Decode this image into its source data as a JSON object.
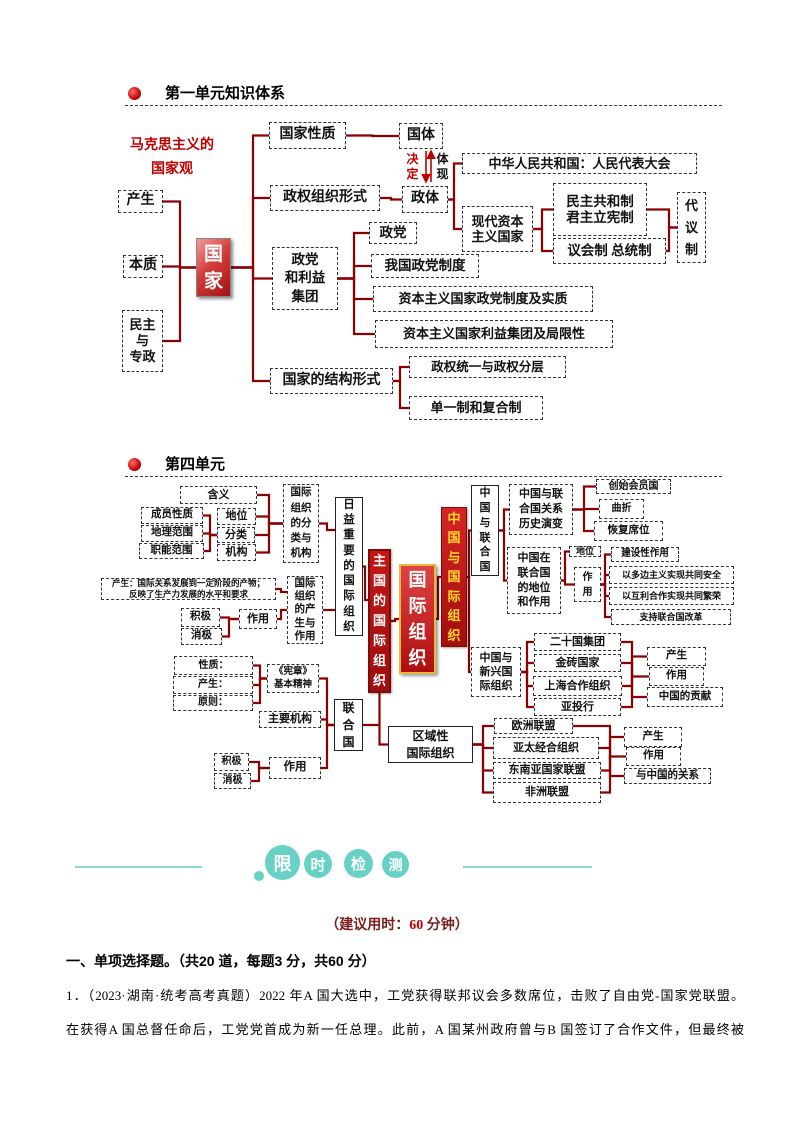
{
  "colors": {
    "connector": "#8b0000",
    "arrow": "#c00000",
    "teal": "#68d1c6",
    "teal_line": "#8adcd3",
    "dark_red_text": "#7b1d1d",
    "accent_red": "#c00000"
  },
  "section1": {
    "title": "第一单元知识体系"
  },
  "section2": {
    "title": "第四单元"
  },
  "diagram1": {
    "label": "马克思主义的\n国家观",
    "nodes": [
      {
        "id": "mk",
        "t": "马克思主义的\n国家观",
        "x": 120,
        "y": 136,
        "w": 104,
        "h": 44,
        "cls": "plain",
        "fs": 14,
        "col": "#c00000",
        "lh": "1.75"
      },
      {
        "id": "chansheng1",
        "t": "产生",
        "x": 118,
        "y": 190,
        "w": 45,
        "h": 23,
        "fs": 14
      },
      {
        "id": "benzhi",
        "t": "本质",
        "x": 123,
        "y": 255,
        "w": 40,
        "h": 23,
        "fs": 14
      },
      {
        "id": "minzhu",
        "t": "民主\n与\n专政",
        "x": 122,
        "y": 310,
        "w": 41,
        "h": 62,
        "fs": 13,
        "lh": "1.25"
      },
      {
        "id": "guojia",
        "t": "国\n家",
        "x": 196,
        "y": 238,
        "w": 35,
        "h": 59,
        "cls": "gj",
        "fs": 19,
        "lh": "27px"
      },
      {
        "id": "gjxz",
        "t": "国家性质",
        "x": 269,
        "y": 122,
        "w": 77,
        "h": 27,
        "fs": 14
      },
      {
        "id": "guoti",
        "t": "国体",
        "x": 399,
        "y": 123,
        "w": 44,
        "h": 26,
        "fs": 14
      },
      {
        "id": "jueding",
        "t": "决\n定",
        "x": 404,
        "y": 151,
        "w": 17,
        "h": 32,
        "cls": "plain",
        "fs": 12,
        "col": "#c00000",
        "lh": "15px"
      },
      {
        "id": "tixian",
        "t": "体\n现",
        "x": 434,
        "y": 151,
        "w": 17,
        "h": 32,
        "cls": "plain",
        "fs": 12,
        "lh": "15px"
      },
      {
        "id": "zqzzxs",
        "t": "政权组织形式",
        "x": 270,
        "y": 185,
        "w": 110,
        "h": 26,
        "fs": 14
      },
      {
        "id": "zhengti",
        "t": "政体",
        "x": 402,
        "y": 186,
        "w": 46,
        "h": 27,
        "fs": 14
      },
      {
        "id": "zhonghua",
        "t": "中华人民共和国：人民代表大会",
        "x": 462,
        "y": 153,
        "w": 235,
        "h": 21,
        "fs": 13
      },
      {
        "id": "xiandai",
        "t": "现代资本\n主义国家",
        "x": 462,
        "y": 206,
        "w": 71,
        "h": 46,
        "fs": 13
      },
      {
        "id": "minzhugonghe",
        "t": "民主共和制\n君主立宪制",
        "x": 553,
        "y": 183,
        "w": 94,
        "h": 53,
        "fs": 13.5
      },
      {
        "id": "yihui",
        "t": "议会制 总统制",
        "x": 553,
        "y": 238,
        "w": 113,
        "h": 26,
        "fs": 13.5
      },
      {
        "id": "daiyizhi",
        "t": "代\n议\n制",
        "x": 677,
        "y": 192,
        "w": 29,
        "h": 71,
        "fs": 13,
        "lh": "22px"
      },
      {
        "id": "zhengdang",
        "t": "政党",
        "x": 369,
        "y": 222,
        "w": 48,
        "h": 22,
        "fs": 13.5
      },
      {
        "id": "zdlyjt",
        "t": "政党\n和利益\n集团",
        "x": 272,
        "y": 247,
        "w": 66,
        "h": 63,
        "fs": 13.5,
        "lh": "1.35"
      },
      {
        "id": "wgzd",
        "t": "我国政党制度",
        "x": 371,
        "y": 254,
        "w": 108,
        "h": 24,
        "fs": 13.5
      },
      {
        "id": "zbzy1",
        "t": "资本主义国家政党制度及实质",
        "x": 373,
        "y": 286,
        "w": 220,
        "h": 26,
        "fs": 13
      },
      {
        "id": "zbzy2",
        "t": "资本主义国家利益集团及局限性",
        "x": 375,
        "y": 320,
        "w": 238,
        "h": 28,
        "fs": 13
      },
      {
        "id": "jgxs",
        "t": "国家的结构形式",
        "x": 270,
        "y": 368,
        "w": 123,
        "h": 26,
        "fs": 14
      },
      {
        "id": "zqty",
        "t": "政权统一与政权分层",
        "x": 409,
        "y": 356,
        "w": 157,
        "h": 22,
        "fs": 12.5
      },
      {
        "id": "dyz",
        "t": "单一制和复合制",
        "x": 409,
        "y": 396,
        "w": 134,
        "h": 24,
        "fs": 13
      }
    ],
    "edges": [
      [
        "chansheng1",
        "guojia",
        180
      ],
      [
        "benzhi",
        "guojia",
        180
      ],
      [
        "minzhu",
        "guojia",
        180
      ],
      [
        "guojia",
        "gjxz",
        253
      ],
      [
        "guojia",
        "zqzzxs",
        253
      ],
      [
        "guojia",
        "zdlyjt",
        253
      ],
      [
        "guojia",
        "jgxs",
        253
      ],
      [
        "gjxz",
        "guoti"
      ],
      [
        "zqzzxs",
        "zhengti"
      ],
      [
        "zhengti",
        "zhonghua",
        454
      ],
      [
        "zhengti",
        "xiandai",
        454
      ],
      [
        "xiandai",
        "minzhugonghe",
        542
      ],
      [
        "xiandai",
        "yihui",
        542
      ],
      [
        "minzhugonghe",
        "daiyizhi",
        669
      ],
      [
        "yihui",
        "daiyizhi",
        669
      ],
      [
        "zdlyjt",
        "zhengdang",
        354
      ],
      [
        "zdlyjt",
        "wgzd",
        354
      ],
      [
        "zdlyjt",
        "zbzy1",
        354
      ],
      [
        "zdlyjt",
        "zbzy2",
        354
      ],
      [
        "jgxs",
        "zqty",
        400
      ],
      [
        "jgxs",
        "dyz",
        400
      ]
    ],
    "arrows": [
      {
        "x": 426,
        "y1": 151,
        "y2": 182
      },
      {
        "x": 431,
        "y1": 182,
        "y2": 151
      }
    ]
  },
  "diagram2": {
    "nodes": [
      {
        "id": "hanyi",
        "t": "含义",
        "x": 180,
        "y": 486,
        "w": 77,
        "h": 18,
        "fs": 11
      },
      {
        "id": "cyxz",
        "t": "成员性质",
        "x": 141,
        "y": 507,
        "w": 62,
        "h": 17,
        "fs": 10.5
      },
      {
        "id": "dlfw",
        "t": "地理范围",
        "x": 141,
        "y": 525,
        "w": 62,
        "h": 17,
        "fs": 10.5
      },
      {
        "id": "znfw",
        "t": "职能范围",
        "x": 139,
        "y": 543,
        "w": 65,
        "h": 16,
        "fs": 10.5
      },
      {
        "id": "diwei_l",
        "t": "地位",
        "x": 217,
        "y": 508,
        "w": 39,
        "h": 17,
        "fs": 11
      },
      {
        "id": "fenlei",
        "t": "分类",
        "x": 217,
        "y": 527,
        "w": 38,
        "h": 16,
        "fs": 11
      },
      {
        "id": "jigou",
        "t": "机构",
        "x": 217,
        "y": 544,
        "w": 39,
        "h": 17,
        "fs": 11
      },
      {
        "id": "fljg",
        "t": "国际\n组织\n的分\n类与\n机构",
        "x": 283,
        "y": 484,
        "w": 36,
        "h": 79,
        "fs": 10.5,
        "lh": "15.2px"
      },
      {
        "id": "riyi",
        "t": "日\n益\n重\n要\n的\n国\n际\n组\n织",
        "x": 335,
        "y": 497,
        "w": 28,
        "h": 139,
        "cls": "s",
        "fs": 11.5,
        "lh": "15.2px"
      },
      {
        "id": "cs_long",
        "t": "产生：国际关系发展到一定阶段的产物；\n反映了生产力发展的水平和要求",
        "x": 101,
        "y": 578,
        "w": 175,
        "h": 22,
        "fs": 8.5,
        "lh": "1.25"
      },
      {
        "id": "jiji1",
        "t": "积极",
        "x": 181,
        "y": 608,
        "w": 39,
        "h": 19,
        "fs": 10.5
      },
      {
        "id": "xiaoji1",
        "t": "消极",
        "x": 181,
        "y": 628,
        "w": 41,
        "h": 17,
        "fs": 10.5
      },
      {
        "id": "zuoyong_l",
        "t": "作用",
        "x": 239,
        "y": 609,
        "w": 38,
        "h": 20,
        "fs": 11
      },
      {
        "id": "cszy",
        "t": "国际\n组织\n的产\n生与\n作用",
        "x": 287,
        "y": 576,
        "w": 36,
        "h": 68,
        "fs": 10.5,
        "lh": "13.2px"
      },
      {
        "id": "zhuguo",
        "t": "主\n国\n的\n国\n际\n组\n织",
        "x": 368,
        "y": 549,
        "w": 23,
        "h": 144,
        "cls": "redv",
        "fs": 13,
        "lh": "20px"
      },
      {
        "id": "gjzz",
        "t": "国\n际\n组\n织",
        "x": 399,
        "y": 564,
        "w": 37,
        "h": 110,
        "cls": "redc",
        "fs": 18,
        "lh": "26px"
      },
      {
        "id": "zgygjzz",
        "t": "中\n国\n与\n国\n际\n组\n织",
        "x": 441,
        "y": 507,
        "w": 26,
        "h": 140,
        "cls": "redy",
        "fs": 13,
        "lh": "19.5px"
      },
      {
        "id": "zgylhg",
        "t": "中\n国\n与\n联\n合\n国",
        "x": 471,
        "y": 485,
        "w": 28,
        "h": 91,
        "cls": "s",
        "fs": 11,
        "lh": "14.8px"
      },
      {
        "id": "gxls",
        "t": "中国与联\n合国关系\n历史演变",
        "x": 509,
        "y": 484,
        "w": 64,
        "h": 51,
        "fs": 11,
        "lh": "1.35"
      },
      {
        "id": "cshyg",
        "t": "创始会员国",
        "x": 596,
        "y": 479,
        "w": 75,
        "h": 15,
        "fs": 10
      },
      {
        "id": "quzhe",
        "t": "曲折",
        "x": 599,
        "y": 499,
        "w": 45,
        "h": 20,
        "fs": 10
      },
      {
        "id": "hfxw",
        "t": "恢复席位",
        "x": 594,
        "y": 521,
        "w": 69,
        "h": 20,
        "fs": 10.5
      },
      {
        "id": "zgzlhg",
        "t": "中国在\n联合国\n的地位\n和作用",
        "x": 507,
        "y": 547,
        "w": 54,
        "h": 67,
        "fs": 11,
        "lh": "1.35"
      },
      {
        "id": "diwei_r",
        "t": "地位",
        "x": 569,
        "y": 546,
        "w": 32,
        "h": 11,
        "fs": 9
      },
      {
        "id": "zuoyong_r",
        "t": "作\n用",
        "x": 574,
        "y": 567,
        "w": 27,
        "h": 35,
        "fs": 10,
        "lh": "15px"
      },
      {
        "id": "jsxzy",
        "t": "建设性作用",
        "x": 611,
        "y": 547,
        "w": 68,
        "h": 15,
        "fs": 9.5
      },
      {
        "id": "ydbzy",
        "t": "以多边主义实现共同安全",
        "x": 609,
        "y": 566,
        "w": 125,
        "h": 18,
        "fs": 9
      },
      {
        "id": "yhlhz",
        "t": "以互利合作实现共同繁荣",
        "x": 609,
        "y": 587,
        "w": 125,
        "h": 18,
        "fs": 9
      },
      {
        "id": "zclhg",
        "t": "支持联合国改革",
        "x": 611,
        "y": 609,
        "w": 120,
        "h": 16,
        "fs": 9
      },
      {
        "id": "zgyxx",
        "t": "中国与\n新兴国\n际组织",
        "x": 471,
        "y": 647,
        "w": 50,
        "h": 50,
        "fs": 11,
        "lh": "1.3"
      },
      {
        "id": "esg",
        "t": "二十国集团",
        "x": 534,
        "y": 633,
        "w": 87,
        "h": 18,
        "fs": 11
      },
      {
        "id": "jz",
        "t": "金砖国家",
        "x": 534,
        "y": 654,
        "w": 87,
        "h": 18,
        "fs": 11
      },
      {
        "id": "shhz",
        "t": "上海合作组织",
        "x": 533,
        "y": 676,
        "w": 89,
        "h": 20,
        "fs": 11
      },
      {
        "id": "ytouh",
        "t": "亚投行",
        "x": 534,
        "y": 698,
        "w": 87,
        "h": 18,
        "fs": 11
      },
      {
        "id": "cs_r1",
        "t": "产生",
        "x": 647,
        "y": 647,
        "w": 59,
        "h": 19,
        "fs": 10.5
      },
      {
        "id": "zy_r1",
        "t": "作用",
        "x": 649,
        "y": 667,
        "w": 55,
        "h": 19,
        "fs": 10.5
      },
      {
        "id": "zggx",
        "t": "中国的贡献",
        "x": 647,
        "y": 687,
        "w": 76,
        "h": 20,
        "fs": 10.5
      },
      {
        "id": "xingzhi",
        "t": "性质：",
        "x": 174,
        "y": 656,
        "w": 79,
        "h": 19,
        "fs": 10
      },
      {
        "id": "chansheng2",
        "t": "产生：",
        "x": 173,
        "y": 676,
        "w": 80,
        "h": 18,
        "fs": 10
      },
      {
        "id": "yuanze",
        "t": "原则：",
        "x": 173,
        "y": 695,
        "w": 80,
        "h": 16,
        "fs": 10
      },
      {
        "id": "xianzhang",
        "t": "《宪章》\n基本精神",
        "x": 267,
        "y": 664,
        "w": 52,
        "h": 29,
        "fs": 9.5,
        "lh": "1.3"
      },
      {
        "id": "zyjg",
        "t": "主要机构",
        "x": 259,
        "y": 711,
        "w": 62,
        "h": 17,
        "fs": 11
      },
      {
        "id": "jiji2",
        "t": "积极",
        "x": 214,
        "y": 753,
        "w": 35,
        "h": 18,
        "fs": 10
      },
      {
        "id": "xiaoji2",
        "t": "消极",
        "x": 214,
        "y": 773,
        "w": 37,
        "h": 16,
        "fs": 10
      },
      {
        "id": "zuoyong2",
        "t": "作用",
        "x": 269,
        "y": 757,
        "w": 52,
        "h": 22,
        "fs": 11.5
      },
      {
        "id": "lhg",
        "t": "联\n合\n国",
        "x": 334,
        "y": 699,
        "w": 29,
        "h": 52,
        "cls": "s",
        "fs": 12,
        "lh": "17px"
      },
      {
        "id": "quyu",
        "t": "区域性\n国际组织",
        "x": 388,
        "y": 726,
        "w": 85,
        "h": 37,
        "cls": "s",
        "fs": 12,
        "lh": "1.4"
      },
      {
        "id": "oumeng",
        "t": "欧洲联盟",
        "x": 494,
        "y": 718,
        "w": 79,
        "h": 16,
        "fs": 11
      },
      {
        "id": "yataijh",
        "t": "亚太经合组织",
        "x": 493,
        "y": 737,
        "w": 106,
        "h": 22,
        "fs": 11
      },
      {
        "id": "dongmeng",
        "t": "东南亚国家联盟",
        "x": 493,
        "y": 762,
        "w": 108,
        "h": 17,
        "fs": 11
      },
      {
        "id": "feimeng",
        "t": "非洲联盟",
        "x": 493,
        "y": 782,
        "w": 108,
        "h": 21,
        "fs": 11
      },
      {
        "id": "cs_r2",
        "t": "产生",
        "x": 624,
        "y": 727,
        "w": 58,
        "h": 20,
        "fs": 10.5
      },
      {
        "id": "zy_r2",
        "t": "作用",
        "x": 626,
        "y": 747,
        "w": 55,
        "h": 19,
        "fs": 10.5
      },
      {
        "id": "yzgdgx",
        "t": "与中国的关系",
        "x": 624,
        "y": 768,
        "w": 87,
        "h": 16,
        "fs": 10.5
      },
      {
        "id": "jx1",
        "t": "",
        "x": 632,
        "y": 677,
        "w": 0,
        "h": 0,
        "jx": true
      },
      {
        "id": "jx2",
        "t": "",
        "x": 610,
        "y": 760,
        "w": 0,
        "h": 0,
        "jx": true
      },
      {
        "id": "jx3",
        "t": "",
        "x": 379,
        "y": 724,
        "w": 0,
        "h": 0,
        "jx": true
      }
    ],
    "edges": [
      [
        "cyxz",
        "fenlei",
        210
      ],
      [
        "dlfw",
        "fenlei",
        210
      ],
      [
        "znfw",
        "fenlei",
        210
      ],
      [
        "hanyi",
        "fljg",
        269
      ],
      [
        "diwei_l",
        "fljg",
        269
      ],
      [
        "fenlei",
        "fljg",
        269
      ],
      [
        "jigou",
        "fljg",
        269
      ],
      [
        "cs_long",
        "cszy",
        281,
        592
      ],
      [
        "jiji1",
        "zuoyong_l",
        229
      ],
      [
        "xiaoji1",
        "zuoyong_l",
        229
      ],
      [
        "zuoyong_l",
        "cszy",
        281
      ],
      [
        "fljg",
        "riyi",
        327,
        530
      ],
      [
        "cszy",
        "riyi",
        329,
        610
      ],
      [
        "riyi",
        "zhuguo",
        365,
        600
      ],
      [
        "zhuguo",
        "gjzz",
        395
      ],
      [
        "gjzz",
        "zgygjzz",
        438
      ],
      [
        "zgygjzz",
        "zgylhg",
        469
      ],
      [
        "zgygjzz",
        "zgyxx",
        469
      ],
      [
        "zgylhg",
        "gxls",
        504
      ],
      [
        "zgylhg",
        "zgzlhg",
        504
      ],
      [
        "gxls",
        "cshyg",
        584
      ],
      [
        "gxls",
        "quzhe",
        584
      ],
      [
        "gxls",
        "hfxw",
        584
      ],
      [
        "zgzlhg",
        "diwei_r",
        565
      ],
      [
        "zgzlhg",
        "zuoyong_r",
        565
      ],
      [
        "zuoyong_r",
        "jsxzy",
        605
      ],
      [
        "zuoyong_r",
        "ydbzy",
        605
      ],
      [
        "zuoyong_r",
        "yhlhz",
        605
      ],
      [
        "zuoyong_r",
        "zclhg",
        605
      ],
      [
        "zgyxx",
        "esg",
        527
      ],
      [
        "zgyxx",
        "jz",
        527
      ],
      [
        "zgyxx",
        "shhz",
        527
      ],
      [
        "zgyxx",
        "ytouh",
        527
      ],
      [
        "esg",
        "jx1",
        632
      ],
      [
        "jz",
        "jx1",
        632
      ],
      [
        "shhz",
        "jx1",
        632
      ],
      [
        "ytouh",
        "jx1",
        632
      ],
      [
        "jx1",
        "cs_r1",
        632
      ],
      [
        "jx1",
        "zy_r1",
        632
      ],
      [
        "jx1",
        "zggx",
        632
      ],
      [
        "xingzhi",
        "xianzhang",
        260
      ],
      [
        "chansheng2",
        "xianzhang",
        260
      ],
      [
        "yuanze",
        "xianzhang",
        260
      ],
      [
        "xianzhang",
        "lhg",
        327
      ],
      [
        "zyjg",
        "lhg",
        327
      ],
      [
        "jiji2",
        "zuoyong2",
        259
      ],
      [
        "xiaoji2",
        "zuoyong2",
        259
      ],
      [
        "zuoyong2",
        "lhg",
        327
      ],
      [
        "lhg",
        "jx3",
        379
      ],
      [
        "zhuguo",
        "quyu",
        0,
        0,
        "v"
      ],
      [
        "quyu",
        "oumeng",
        483
      ],
      [
        "quyu",
        "yataijh",
        483
      ],
      [
        "quyu",
        "dongmeng",
        483
      ],
      [
        "quyu",
        "feimeng",
        483
      ],
      [
        "oumeng",
        "jx2",
        610
      ],
      [
        "yataijh",
        "jx2",
        610
      ],
      [
        "dongmeng",
        "jx2",
        610
      ],
      [
        "feimeng",
        "jx2",
        610
      ],
      [
        "jx2",
        "cs_r2",
        610
      ],
      [
        "jx2",
        "zy_r2",
        610
      ],
      [
        "jx2",
        "yzgdgx",
        610
      ]
    ]
  },
  "timed_test": {
    "badges": [
      {
        "ch": "限",
        "x": 265,
        "y": 845,
        "d": 35,
        "fs": 18
      },
      {
        "ch": "时",
        "x": 304,
        "y": 850,
        "d": 28,
        "fs": 15
      },
      {
        "ch": "检",
        "x": 344,
        "y": 849,
        "d": 29,
        "fs": 15
      },
      {
        "ch": "测",
        "x": 382,
        "y": 851,
        "d": 27,
        "fs": 14
      }
    ],
    "dot": {
      "x": 254,
      "y": 871,
      "d": 10
    },
    "lines": [
      {
        "x1": 75,
        "x2": 202,
        "y": 866
      },
      {
        "x1": 463,
        "x2": 592,
        "y": 866
      }
    ],
    "suggest": {
      "prefix": "（建议用时：",
      "num": "60",
      "suffix": " 分钟）"
    }
  },
  "questions": {
    "header": "一、单项选择题。（共20 道，每题3 分，共60 分）",
    "line1": "1．（2023·湖南·统考高考真题）2022 年A 国大选中，工党获得联邦议会多数席位，击败了自由党-国家党联盟。",
    "line2": "在获得A 国总督任命后，工党党首成为新一任总理。此前，A 国某州政府曾与B 国签订了合作文件，但最终被"
  }
}
